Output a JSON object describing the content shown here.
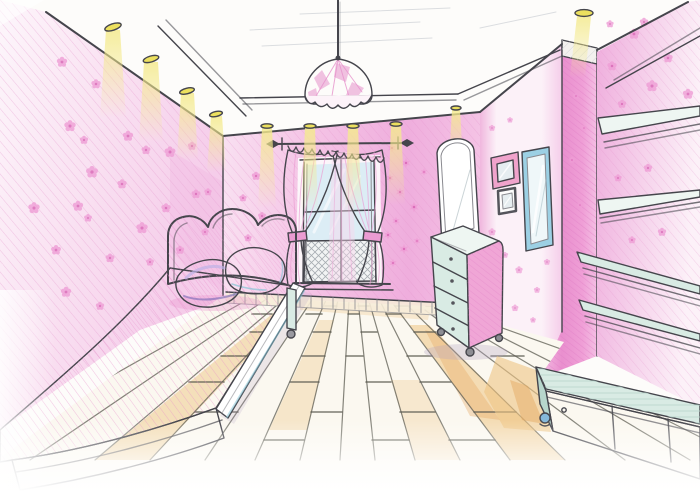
{
  "scene": {
    "medium": "hand-drawn interior design sketch, colored pencil and marker",
    "subject": "girl's bedroom in pink, one-point perspective",
    "elements": [
      {
        "name": "ceiling",
        "desc": "recessed ceiling with perimeter soffit and halogen downlights"
      },
      {
        "name": "pendant-lamp",
        "desc": "pink patchwork dome pendant hanging on a cord"
      },
      {
        "name": "left-wall",
        "desc": "pink wallpaper with scattered flower blooms"
      },
      {
        "name": "window",
        "desc": "balcony door window with crosshatched lower panes"
      },
      {
        "name": "curtains",
        "desc": "two pink tied-back curtains with sheer center panel on a rod with finials"
      },
      {
        "name": "bed",
        "desc": "single bed with scalloped pink headboard, pink bedspread, purple and blue pillows"
      },
      {
        "name": "dresser",
        "desc": "four-drawer chest on casters with leaning vanity mirror"
      },
      {
        "name": "picture-frames",
        "desc": "pink framed picture, small dark framed picture, tall blue wall mirror"
      },
      {
        "name": "shelves",
        "desc": "four open wall shelves on the right wall"
      },
      {
        "name": "bench",
        "desc": "low storage bench with blue caster along the right wall"
      },
      {
        "name": "floor",
        "desc": "light wooden plank floor converging to the vanishing point"
      }
    ],
    "counts": {
      "downlights_left": 4,
      "downlights_back": 4,
      "downlights_right": 2,
      "drawers": 4,
      "shelves": 4,
      "pillows": 2,
      "picture_frames": 2,
      "wall_mirrors": 2
    }
  },
  "colors": {
    "paper": "#fdfcfa",
    "white": "#ffffff",
    "ink": "#45454c",
    "ink_soft": "#8a8a90",
    "shadow": "#b4a2c2",
    "wall_light": "#fdf6fb",
    "wall_mid": "#f9e0f1",
    "wall_pink": "#f5cdea",
    "wall_back": "#f4c3e5",
    "wall_deep": "#efaedd",
    "wall_hatch": "#e393cb",
    "hatch_deep": "#df7dc5",
    "wall_r": "#f6d4ec",
    "frames_edge": "#f0b7de",
    "frames_light": "#fcf1f8",
    "col_light": "#f4c0e4",
    "col_mid": "#ef9fd6",
    "col_deep": "#e98fce",
    "flower": "#ef9ed6",
    "flower_deep": "#d863b4",
    "ceil_hatch": "#d3d6da",
    "cross": "#a7adb2",
    "beam": "#f4ea8e",
    "puck": "#ece05e",
    "lamp": "#f3b2dc",
    "lamp_deep": "#e792cc",
    "curtain": "#f5c3e5",
    "curtain_deep": "#eb9cd2",
    "sheer": "#f8d8ee",
    "glass": "#d8ecf4",
    "headboard": "#f2abd9",
    "headboard_deep": "#e78fc9",
    "spread": "#f1aedb",
    "spread_deep": "#e78cc9",
    "spread_light": "#f9d9ee",
    "pillow_p": "#978bce",
    "pillow_p_dark": "#7568b4",
    "pillow_p_light": "#beb2e6",
    "pillow_b": "#b2e0ea",
    "pillow_b_light": "#dcf2f6",
    "pillow_b_dark": "#84c4d6",
    "teal": "#d9ebe4",
    "teal_deep": "#b7d6cc",
    "teal_light": "#eef6f2",
    "dresser_pink": "#f0a6d6",
    "frame_pink": "#f0a3cc",
    "frame_blue": "#9cd0e4",
    "frame_dark": "#55555c",
    "mirror_glass": "#e6edf0",
    "mirror_deep": "#cdd9de",
    "floor": "#fbf8f0",
    "floor_line": "#5d5c52",
    "tan": "#eec584",
    "tan_deep": "#e4a75e",
    "caster": "#85b8da"
  }
}
